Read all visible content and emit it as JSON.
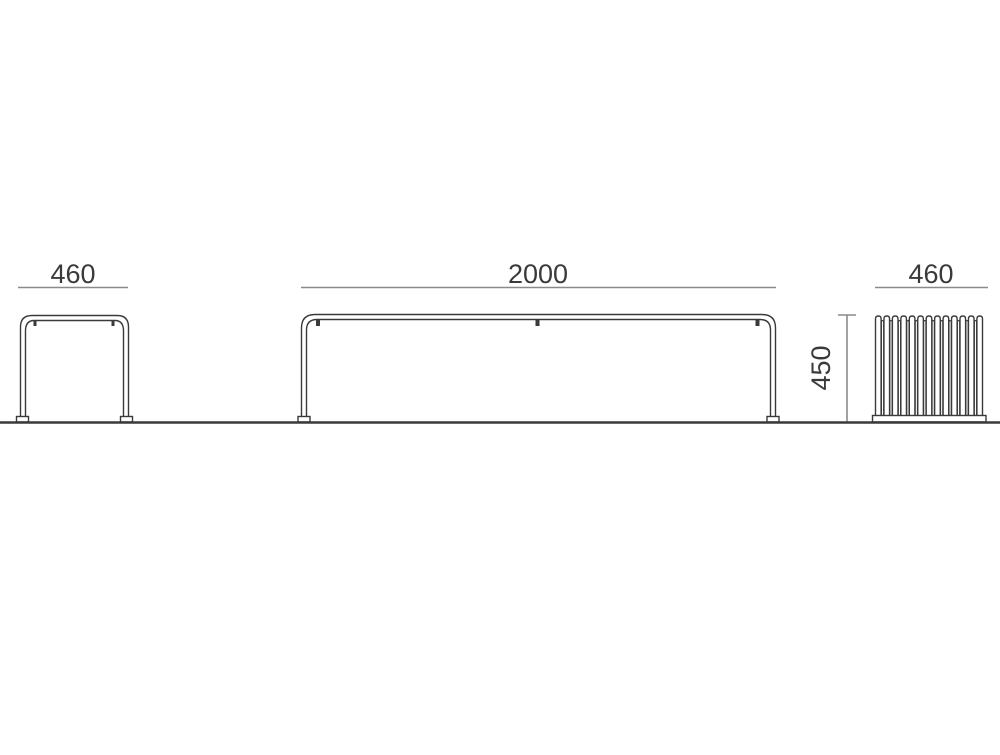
{
  "drawing": {
    "dimensions": {
      "end_view_left_width": "460",
      "bench_length": "2000",
      "bench_height": "450",
      "end_view_right_width": "460"
    },
    "end_view_right": {
      "slat_count": 13
    },
    "colors": {
      "outline": "#3a3a3a",
      "dimension_line": "#8a8a8a",
      "text": "#3a3a3a",
      "background": "#ffffff"
    }
  }
}
